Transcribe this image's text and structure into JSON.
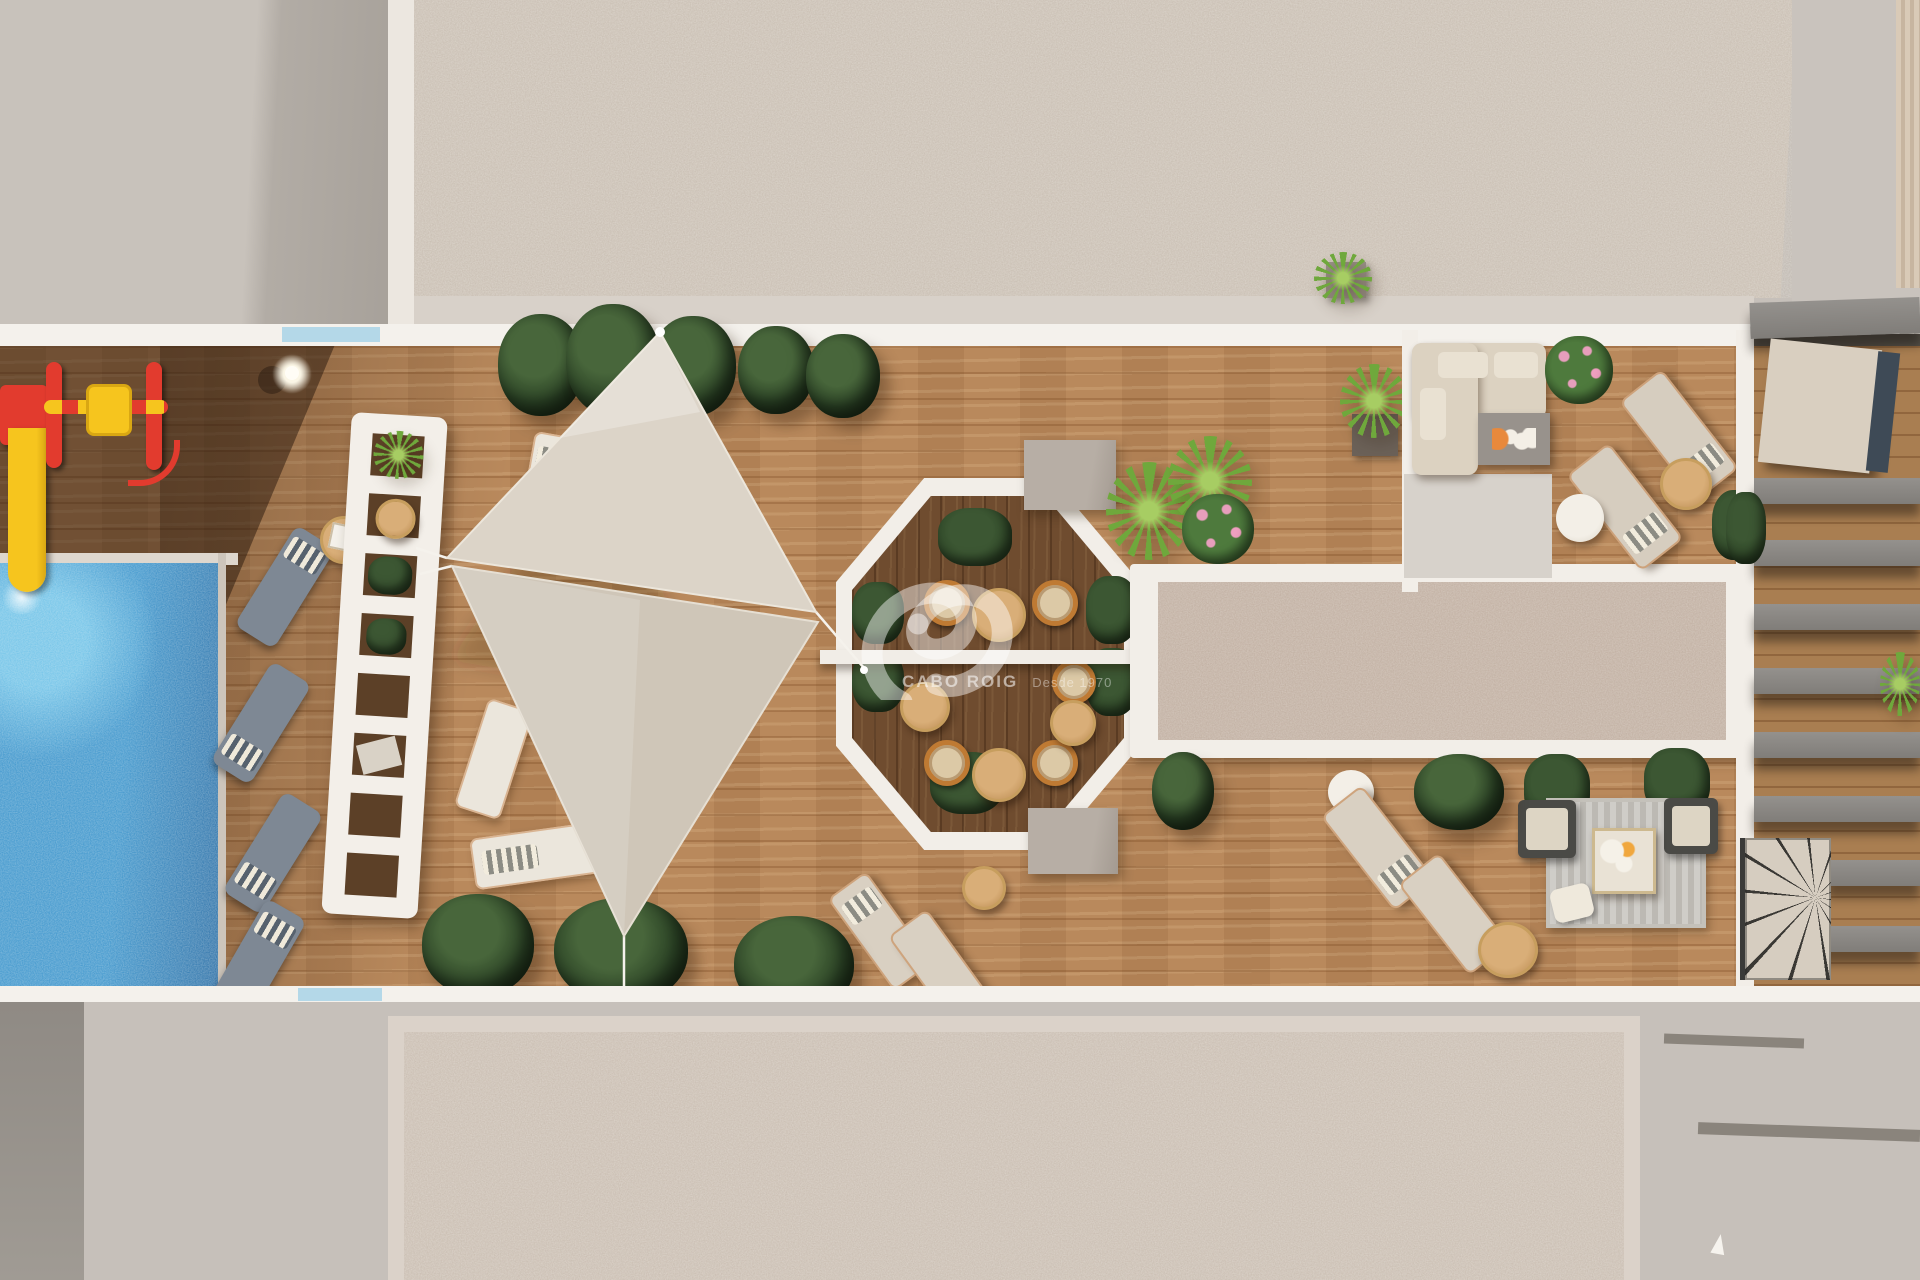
{
  "image": {
    "kind": "3D architectural render",
    "view": "top-down aerial",
    "scene": "Rooftop solarium terrace of a residential building with swimming pool, children's playground, sun-lounger decks, shade sails, octagonal dining pergola, lounge terraces and gravel roof fields"
  },
  "watermark": {
    "logo": "ribbon-swoosh-monogram",
    "brand": "CABO ROIG",
    "tagline": "Desde 1970",
    "text_color": "#ffffff"
  },
  "palette": {
    "deck_wood": "#b9895c",
    "deck_wood_shadow": "#6f4c2f",
    "roof_gravel": "#cfc5ba",
    "gravel_bed": "#c6b4a7",
    "concrete": "#c6c0ba",
    "white_trim": "#f2eee8",
    "pool_water": "#2f86c0",
    "glass_railing": "#a8d4e8",
    "shade_sail": "#d8d0c4",
    "plant_dark_green": "#2c4426",
    "plant_bright_green": "#6fa83c",
    "flower_pink": "#e79ebc",
    "play_red": "#e23b2e",
    "play_yellow": "#f6c51e",
    "lounger_gray": "#7e8894",
    "lounger_beige": "#d6cdbf",
    "sofa_beige": "#dcd2c1",
    "rattan_orange": "#bf7a33",
    "rug_gray": "#c9c6c0"
  },
  "areas": {
    "pool": {
      "label": "swimming pool",
      "water_color": "#2f86c0",
      "coping": "white"
    },
    "playground": {
      "items": [
        "slide",
        "roller-spinner"
      ],
      "colors": [
        "#e23b2e",
        "#f6c51e"
      ],
      "lamp": 1
    },
    "pool_deck": {
      "gray_loungers": 4,
      "side_tables": 1
    },
    "sail_deck": {
      "shade_sails": 2,
      "white_loungers": 4,
      "planter_rows": 2
    },
    "privacy_wall": {
      "type": "white lattice wall with planter openings",
      "openings": 8
    },
    "dining_pergola": {
      "shape": "octagon",
      "round_tables": 4,
      "rattan_chairs": 6,
      "hedges": 6,
      "cross_beam": "white"
    },
    "gravel_bed": {
      "shape": "rectangle",
      "border": "white"
    },
    "lounge_terrace": {
      "sofa": "L-shaped beige sectional",
      "coffee_table": 1,
      "beige_loungers": 2,
      "side_tables": 2,
      "flower_bushes": 2
    },
    "fire_lounge": {
      "rug": "striped gray",
      "armchairs": 2,
      "center_table": 1,
      "planter_bushes": 2
    },
    "bottom_deck": {
      "beige_loungers": 2,
      "round_tables": 3,
      "plants": 4
    },
    "neighbor_terrace": {
      "features": [
        "slatted pergola beams",
        "tilted canopy",
        "spiral staircase"
      ]
    },
    "roof_fields": {
      "texture": "gravel",
      "frame": "beige"
    }
  }
}
